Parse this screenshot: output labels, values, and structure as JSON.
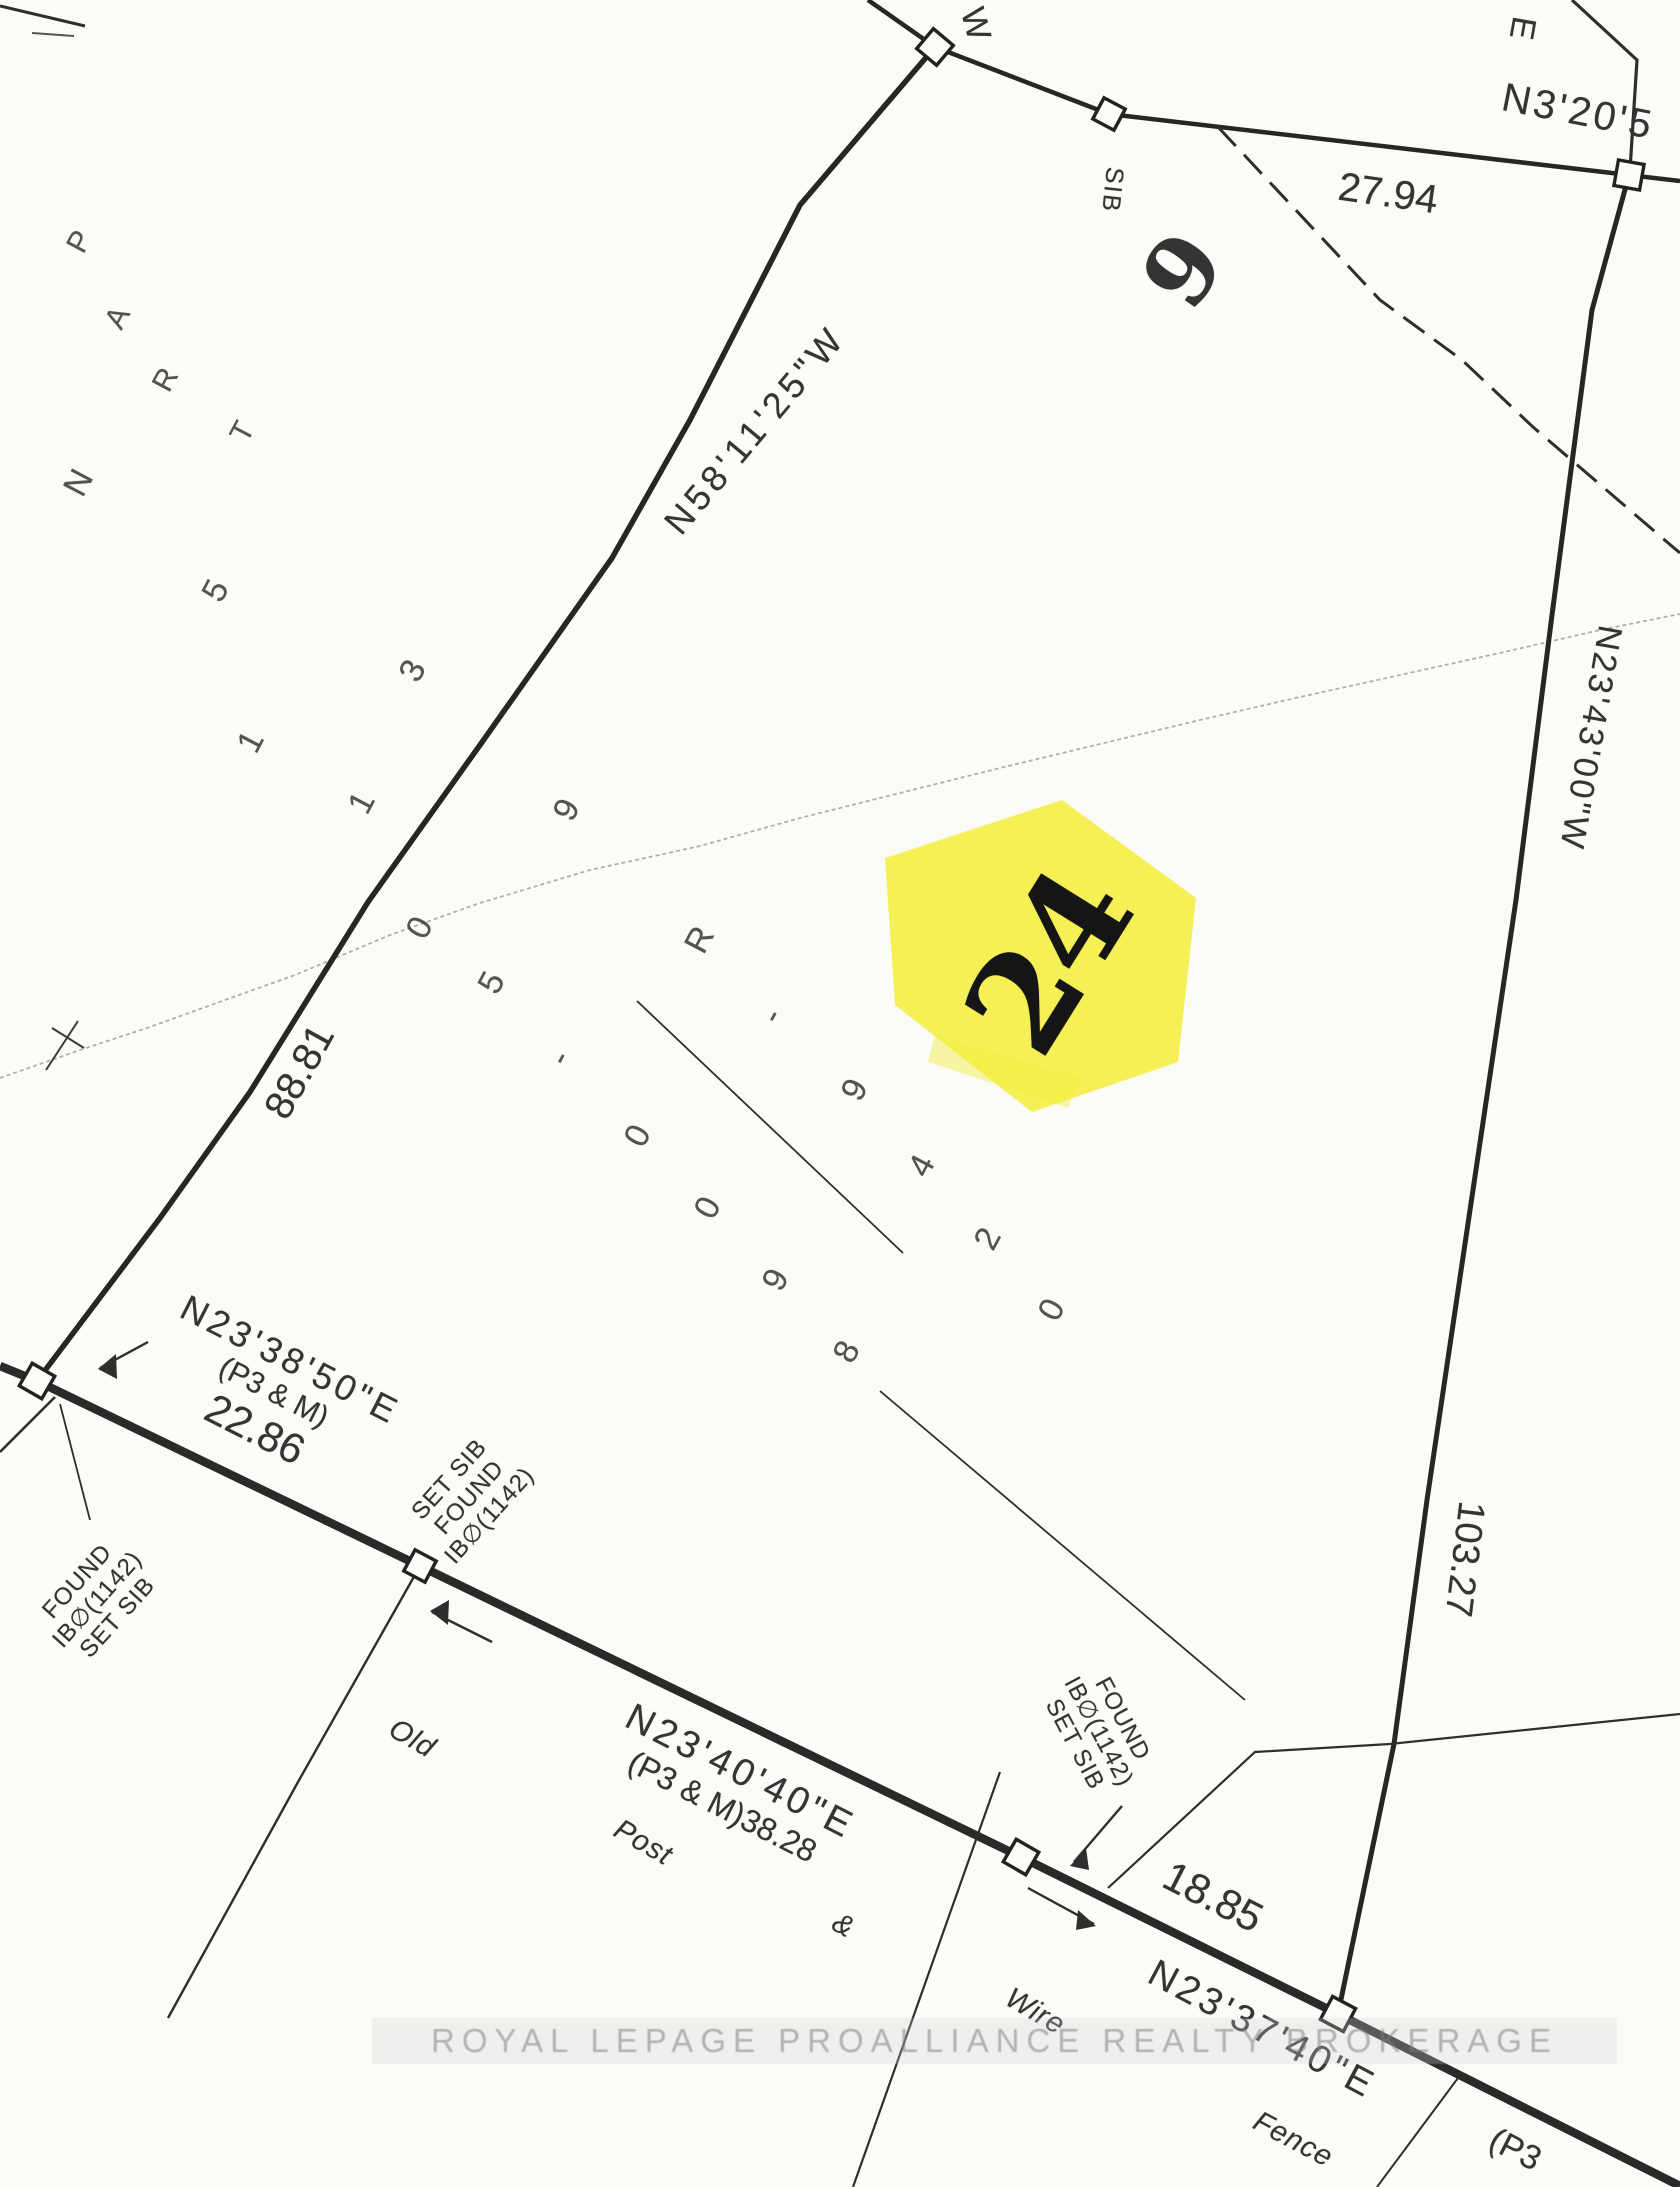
{
  "labels": {
    "bearing_nw": "N58'11'25\"W",
    "distance_west": "88.81",
    "bearing_top": "N3'20'5",
    "distance_top": "27.94",
    "glyph_w": "W",
    "glyph_e": "E",
    "sib": "SIB",
    "lot_9": "9",
    "bearing_east": "N23'43'00\"W",
    "distance_east": "103.27",
    "bearing_road_1": "N23'38'50\"E",
    "ref_road_1": "(P3 & M)",
    "distance_road_1": "22.86",
    "bearing_road_2": "N23'40'40\"E",
    "ref_road_2": "(P3 & M)38.28",
    "distance_road_2": "18.85",
    "bearing_road_3": "N23'37'40\"E",
    "ref_road_3": "(P3",
    "highlight_lot": "24"
  },
  "fence_words": [
    "Old",
    "Post",
    "&",
    "Wire",
    "Fence"
  ],
  "monument_blocks": [
    [
      "FOUND",
      "IB∅(1142)",
      "SET SIB"
    ],
    [
      "SET SIB",
      "FOUND",
      "IB∅(1142)"
    ],
    [
      "FOUND",
      "IB∅(1142)",
      "SET SIB"
    ]
  ],
  "scatter_letters": [
    "P",
    "A",
    "R",
    "T",
    "N"
  ],
  "scatter_digits": [
    "5",
    "1",
    "1",
    "0",
    "5",
    "-",
    "0",
    "0",
    "9",
    "8",
    "3",
    "9",
    "R",
    "-",
    "9",
    "4",
    "2",
    "0"
  ],
  "watermark": "ROYAL LEPAGE PROALLIANCE REALTY BROKERAGE",
  "colors": {
    "highlight_yellow": "#f2ee3f",
    "ink": "#2a2a2a",
    "faint_fence": "#8f8f8f"
  }
}
